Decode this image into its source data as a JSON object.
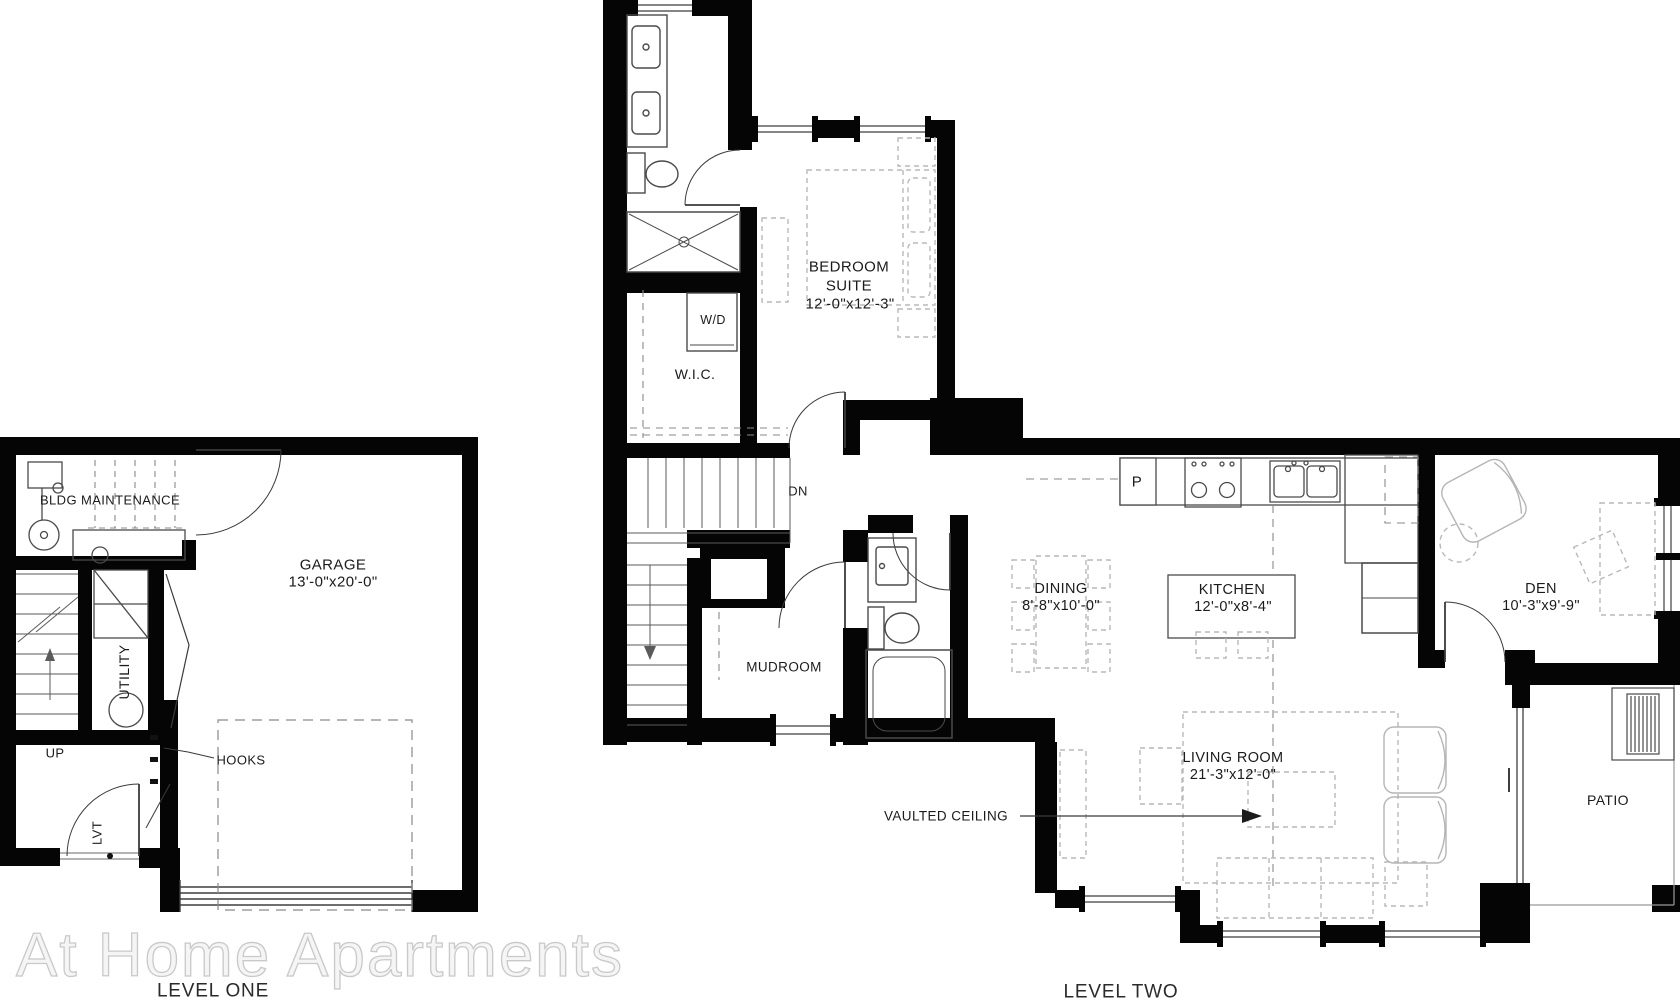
{
  "watermark": "At Home Apartments",
  "level_one": {
    "caption": "LEVEL ONE",
    "rooms": {
      "bldg_maintenance": "BLDG MAINTENANCE",
      "garage_name": "GARAGE",
      "garage_dims": "13'-0\"x20'-0\"",
      "utility": "UTILITY"
    },
    "annotations": {
      "up": "UP",
      "hooks": "HOOKS",
      "lvt": "LVT"
    }
  },
  "level_two": {
    "caption": "LEVEL TWO",
    "rooms": {
      "bedroom_line1": "BEDROOM",
      "bedroom_line2": "SUITE",
      "bedroom_dims": "12'-0\"x12'-3\"",
      "dining_name": "DINING",
      "dining_dims": "8'-8\"x10'-0\"",
      "kitchen_name": "KITCHEN",
      "kitchen_dims": "12'-0\"x8'-4\"",
      "den_name": "DEN",
      "den_dims": "10'-3\"x9'-9\"",
      "living_name": "LIVING ROOM",
      "living_dims": "21'-3\"x12'-0\"",
      "mudroom": "MUDROOM",
      "wic": "W.I.C.",
      "patio": "PATIO"
    },
    "annotations": {
      "wd": "W/D",
      "dn": "DN",
      "pantry": "P",
      "vaulted_ceiling": "VAULTED CEILING"
    }
  },
  "colors": {
    "wall": "#050505",
    "fixture": "#4a4a4a",
    "dashed_item": "#8a8a8a",
    "furniture": "#b9b9b9",
    "text": "#1b1b1b",
    "watermark_fill": "#f5f5f5",
    "watermark_stroke": "#c9c9c9"
  }
}
